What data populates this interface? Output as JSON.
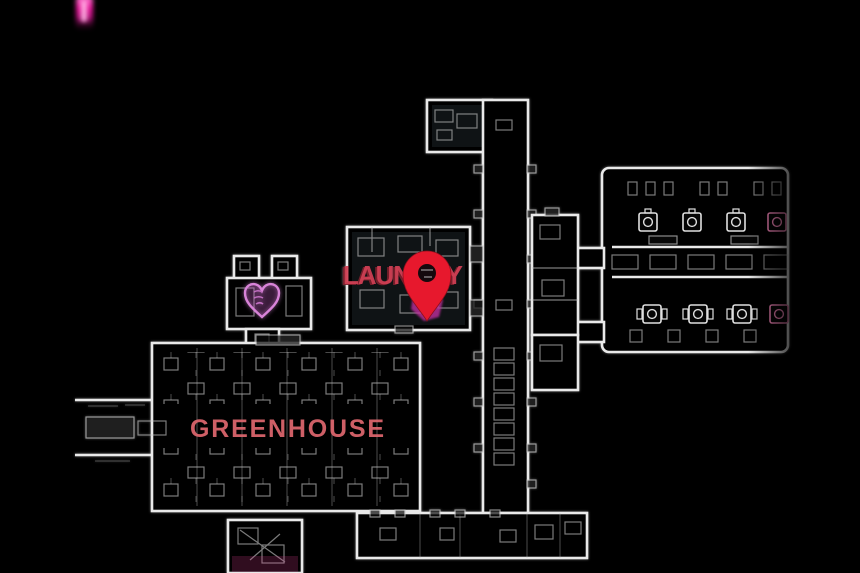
{
  "map": {
    "colors": {
      "background": "#000000",
      "wall_line": "#e9e9e9",
      "laundry_label": "#d24055",
      "laundry_label_shadow": "#7d1f2c",
      "greenhouse_label": "#e0686f",
      "pin_red": "#e7182d",
      "pin_splat_magenta": "#bf2f9f",
      "heart_pink": "#d883d8",
      "glitch_magenta": "#e8189b"
    },
    "rooms": [
      {
        "id": "laundry",
        "label": "LAUNDRY"
      },
      {
        "id": "greenhouse",
        "label": "GREENHOUSE"
      }
    ],
    "markers": [
      {
        "id": "objective-pin",
        "icon": "location-pin-icon"
      },
      {
        "id": "challenge-heart",
        "icon": "heart-icon"
      }
    ],
    "artifacts": [
      {
        "id": "glitch-streak",
        "icon": "glitch-artifact"
      }
    ]
  }
}
